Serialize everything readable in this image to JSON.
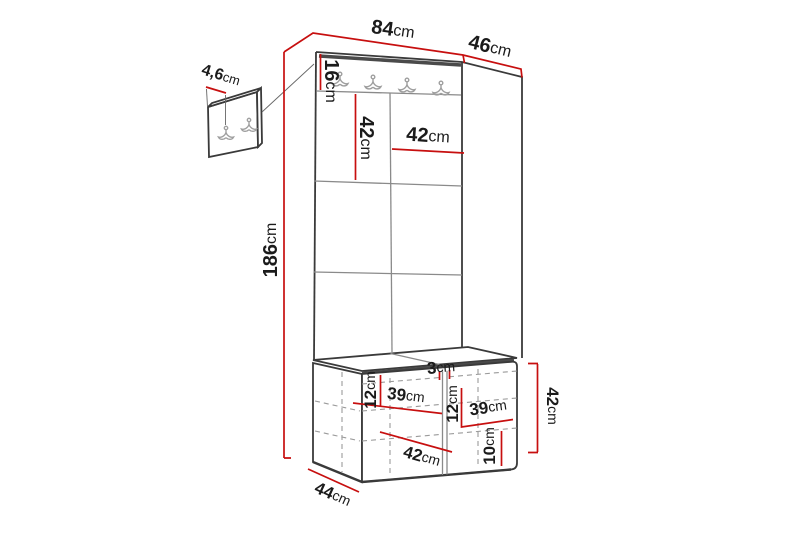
{
  "diagram": {
    "type": "furniture-dimension-drawing",
    "dims": {
      "width_top": {
        "num": "84",
        "unit": "cm"
      },
      "depth_top": {
        "num": "46",
        "unit": "cm"
      },
      "height_total": {
        "num": "186",
        "unit": "cm"
      },
      "rail_height": {
        "num": "16",
        "unit": "cm"
      },
      "panel_height": {
        "num": "42",
        "unit": "cm"
      },
      "panel_width": {
        "num": "42",
        "unit": "cm"
      },
      "wall_panel_thickness": {
        "num": "4,6",
        "unit": "cm"
      },
      "shelf_left_height": {
        "num": "12",
        "unit": "cm"
      },
      "shelf_left_width": {
        "num": "39",
        "unit": "cm"
      },
      "divider_thickness": {
        "num": "3",
        "unit": "cm"
      },
      "shelf_right_height": {
        "num": "12",
        "unit": "cm"
      },
      "shelf_right_width": {
        "num": "39",
        "unit": "cm"
      },
      "plinth_height": {
        "num": "10",
        "unit": "cm"
      },
      "bench_height": {
        "num": "42",
        "unit": "cm"
      },
      "bench_depth": {
        "num": "44",
        "unit": "cm"
      },
      "bench_inner_depth": {
        "num": "42",
        "unit": "cm"
      }
    },
    "icons": [
      "double-coat-hook-icon"
    ],
    "colors": {
      "dimension": "#c70f0f",
      "outline": "#3a3a3a",
      "panel_line": "#8a8a8a",
      "hook": "#9f9f9f"
    }
  }
}
